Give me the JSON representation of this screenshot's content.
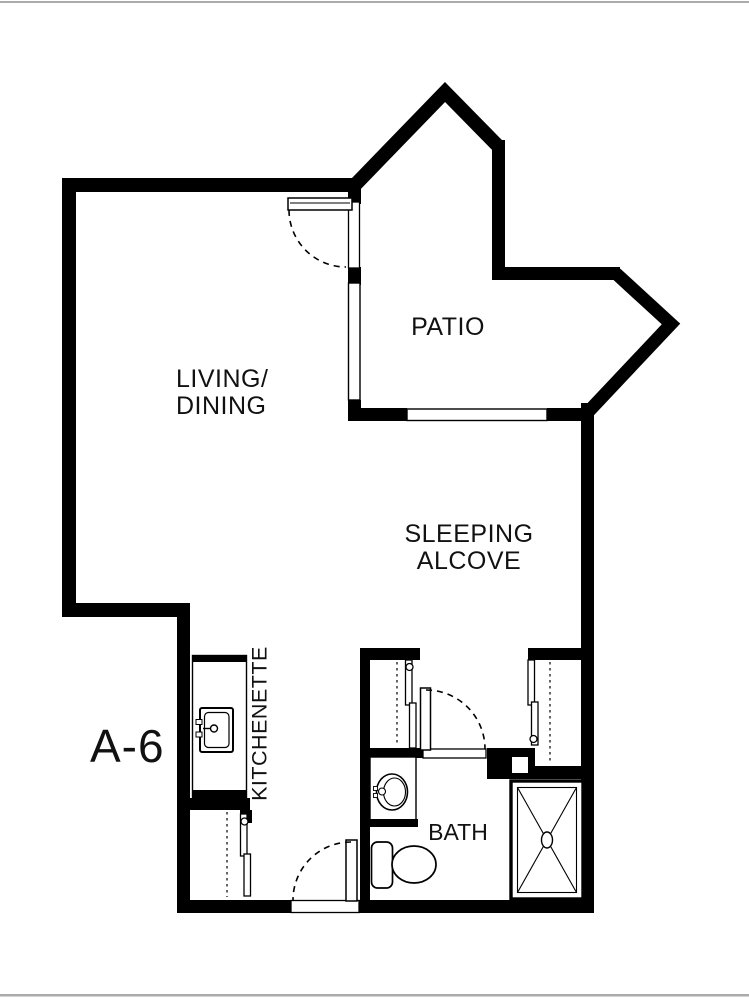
{
  "page": {
    "background": "#ffffff",
    "edge_line_color": "#ababab"
  },
  "plan": {
    "unit_label": "A-6",
    "labels": {
      "living_line1": "LIVING/",
      "living_line2": "DINING",
      "patio": "PATIO",
      "sleeping_line1": "SLEEPING",
      "sleeping_line2": "ALCOVE",
      "bath": "BATH",
      "kitchenette": "KITCHENETTE"
    },
    "colors": {
      "wall": "#000000",
      "text": "#111111"
    },
    "fixtures": [
      "kitchenette-sink",
      "bathroom-sink",
      "toilet",
      "shower",
      "entry-closet-sliding-doors",
      "bath-left-closet-sliding-doors",
      "bath-right-closet-sliding-doors"
    ],
    "doors": [
      "patio-door",
      "unit-entry-door",
      "bath-door"
    ],
    "windows": [
      "living-patio-window",
      "patio-bottom-window"
    ]
  }
}
